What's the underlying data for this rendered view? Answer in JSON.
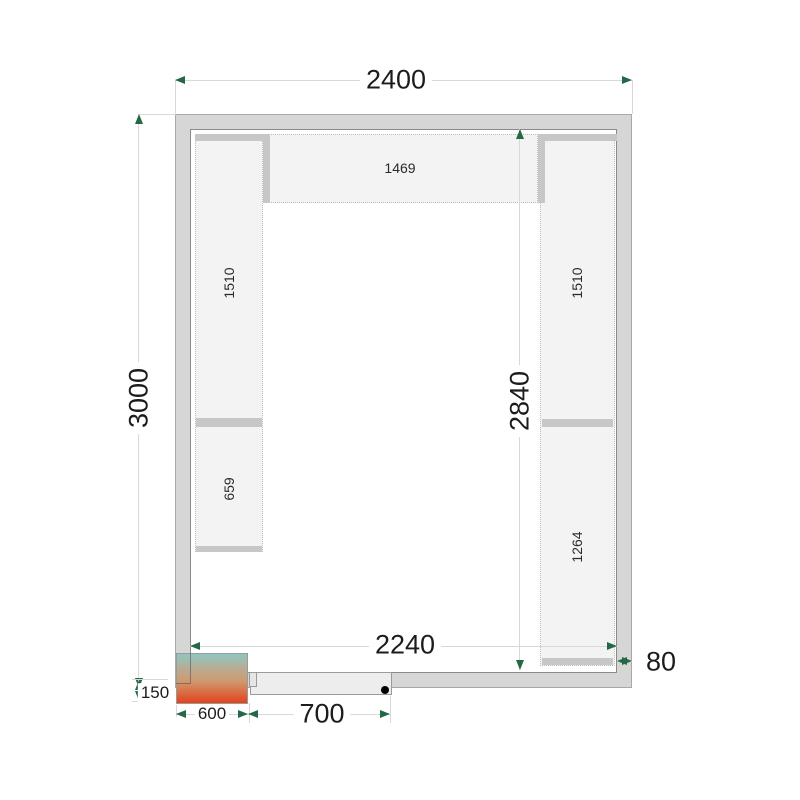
{
  "diagram": {
    "kind": "cold-room-floor-plan",
    "dimensions": {
      "outer_width": "2400",
      "outer_depth": "3000",
      "inner_depth": "2840",
      "inner_width": "2240",
      "door_width": "700",
      "cooling_unit_width": "600",
      "cooling_unit_overhang": "150",
      "panel_thickness": "80"
    },
    "shelves": {
      "top": "1469",
      "left_upper": "1510",
      "left_lower": "659",
      "right_upper": "1510",
      "right_lower": "1264"
    },
    "colors": {
      "wall_fill": "#d6d6d6",
      "shelf_fill": "#f3f3f3",
      "shelf_edge": "#c7c7c7",
      "dimension_line": "#d8d8d8",
      "arrow_green": "#236946",
      "unit_gradient_top": "#8ec7c0",
      "unit_gradient_mid": "#cf9a70",
      "unit_gradient_bottom": "#e2431c"
    }
  }
}
